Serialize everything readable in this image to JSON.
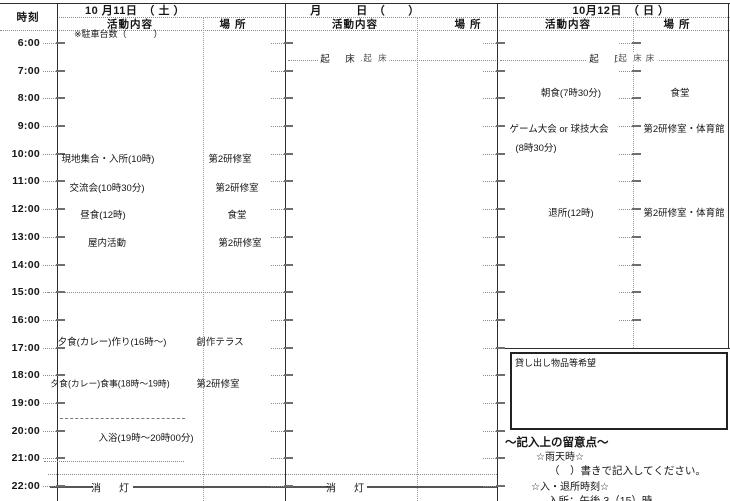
{
  "table": {
    "time_header": "時刻",
    "times": [
      "6:00",
      "7:00",
      "8:00",
      "9:00",
      "10:00",
      "11:00",
      "12:00",
      "13:00",
      "14:00",
      "15:00",
      "16:00",
      "17:00",
      "18:00",
      "19:00",
      "20:00",
      "21:00",
      "22:00"
    ],
    "days": [
      {
        "date": "10 月11日　（ 土 ）",
        "activity_header": "活動内容",
        "place_header": "場 所"
      },
      {
        "date": "月　　　日　（　　）",
        "activity_header": "活動内容",
        "place_header": "場 所"
      },
      {
        "date": "10月12日　（ 日 ）",
        "activity_header": "活動内容",
        "place_header": "場 所"
      }
    ]
  },
  "day1": {
    "parking_note": "※駐車台数（　　　）",
    "activities": [
      {
        "label": "現地集合・入所(10時)",
        "x": 108,
        "y": 158,
        "place": "第2研修室",
        "px": 230
      },
      {
        "label": "交流会(10時30分)",
        "x": 107,
        "y": 187,
        "place": "第2研修室",
        "px": 237
      },
      {
        "label": "昼食(12時)",
        "x": 103,
        "y": 214,
        "place": "食堂",
        "px": 237
      },
      {
        "label": "屋内活動",
        "x": 107,
        "y": 242,
        "place": "第2研修室",
        "px": 240
      },
      {
        "label": "夕食(カレー)作り(16時〜)",
        "x": 112,
        "y": 341,
        "place": "創作テラス",
        "px": 220
      },
      {
        "label": "夕食(カレー)食事(18時〜19時)",
        "x": 110,
        "y": 383,
        "small": true,
        "place": "第2研修室",
        "px": 218
      },
      {
        "label": "入浴(19時〜20時00分)",
        "x": 146,
        "y": 437,
        "place": "",
        "px": 0
      }
    ],
    "lights_out_label": "消　灯"
  },
  "day2": {
    "wake_label_1": "起　床",
    "wake_label_2": "起 床",
    "lights_out_label": "消　灯"
  },
  "day3": {
    "wake_label_1": "起　床",
    "wake_label_2": "起 床",
    "wake_label_3": "床",
    "activities": [
      {
        "label": "朝食(7時30分)",
        "x": 571,
        "y": 92,
        "place": "食堂",
        "px": 680
      },
      {
        "label": "ゲーム大会 or 球技大会",
        "x": 559,
        "y": 128,
        "label2": "(8時30分)",
        "x2": 536,
        "place": "第2研修室・体育館",
        "px": 684
      },
      {
        "label": "退所(12時)",
        "x": 571,
        "y": 212,
        "place": "第2研修室・体育館",
        "px": 684
      }
    ]
  },
  "notes": {
    "lending_box_label": "貸し出し物品等希望",
    "heading": "〜記入上の留意点〜",
    "rain_title": "☆雨天時☆",
    "rain_instruction": "（　）書きで記入してください。",
    "entry_exit_title": "☆入・退所時刻☆",
    "entry_time_line": "入所：午後 3（15）時"
  }
}
